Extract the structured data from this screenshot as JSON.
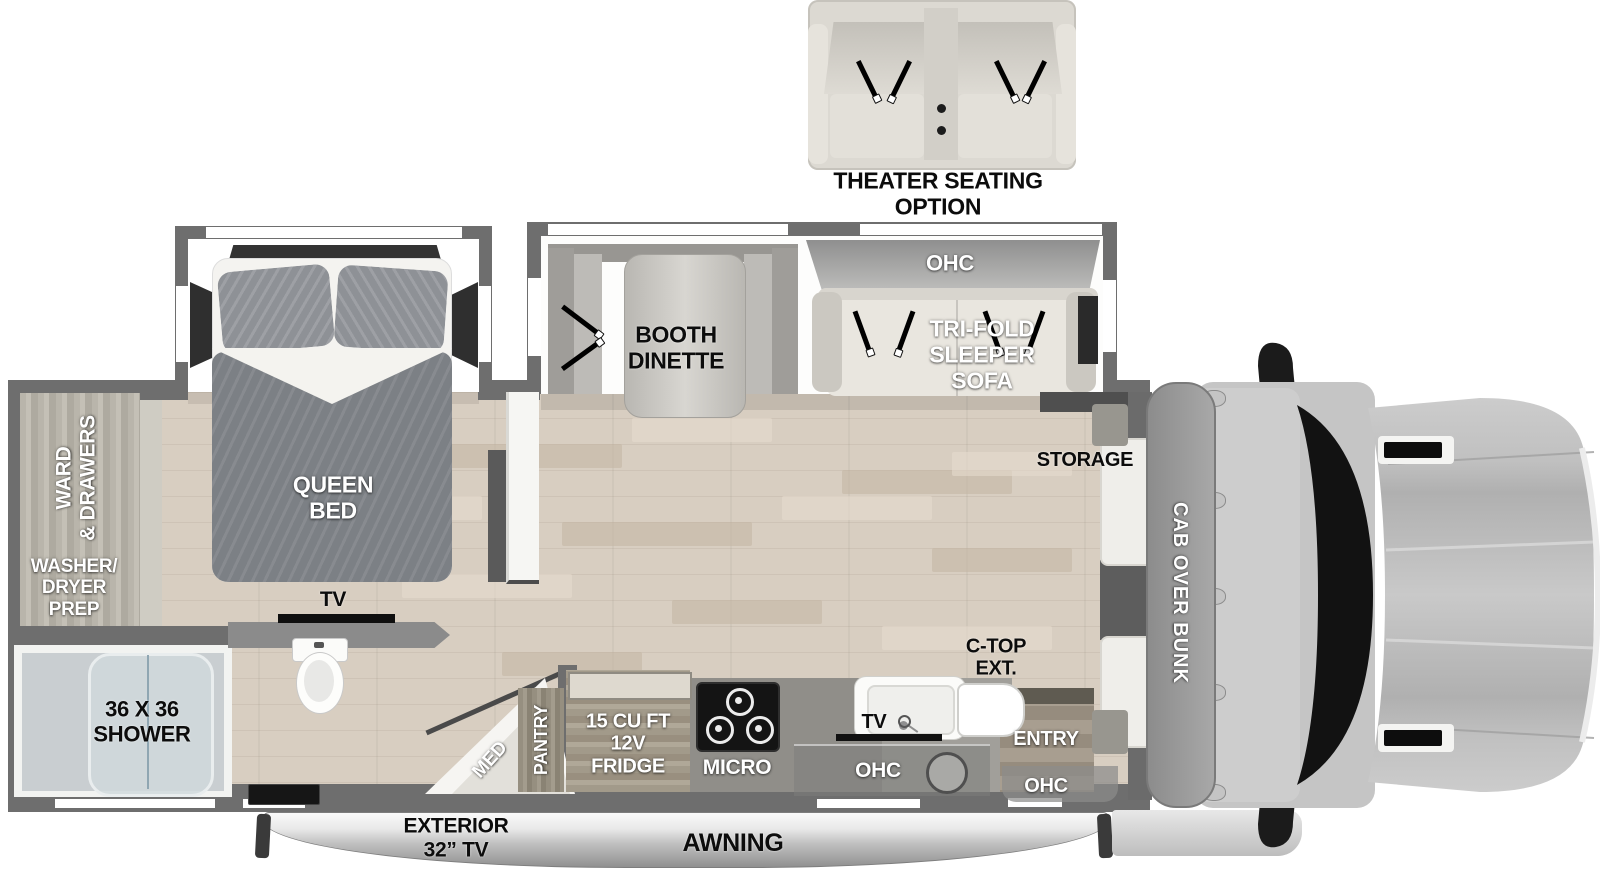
{
  "colors": {
    "wall": "#6e6e6e",
    "floor": "#d8cec1",
    "label_light": "#ffffff",
    "label_dark": "#0c0c0c",
    "windshield": "#121212"
  },
  "theater": {
    "label": "THEATER SEATING\nOPTION"
  },
  "bedroom": {
    "bed_label": "QUEEN\nBED",
    "tv_label": "TV",
    "ward_label": "WARD\n& DRAWERS",
    "washer_label": "WASHER/\nDRYER\nPREP"
  },
  "bath": {
    "shower_label": "36 X 36\nSHOWER",
    "med_label": "MED"
  },
  "dinette": {
    "label": "BOOTH\nDINETTE"
  },
  "sofa": {
    "ohc_label": "OHC",
    "label": "TRI-FOLD\nSLEEPER\nSOFA"
  },
  "kitchen": {
    "pantry_label": "PANTRY",
    "fridge_label": "15 CU FT\n12V\nFRIDGE",
    "micro_label": "MICRO",
    "tv_label": "TV",
    "ohc_label": "OHC",
    "ctop_label": "C-TOP\nEXT."
  },
  "entry": {
    "label": "ENTRY",
    "ohc_label": "OHC"
  },
  "front": {
    "storage_label": "STORAGE",
    "bunk_label": "CAB OVER BUNK"
  },
  "exterior": {
    "tv_label": "EXTERIOR\n32” TV",
    "awning_label": "AWNING"
  }
}
